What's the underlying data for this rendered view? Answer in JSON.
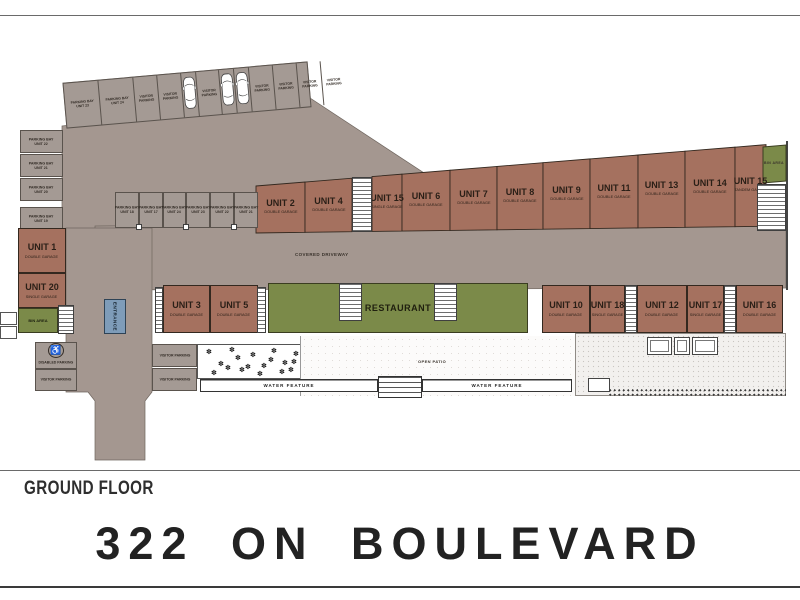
{
  "page": {
    "floor_label": "GROUND FLOOR",
    "title": "322 ON BOULEVARD"
  },
  "labels": {
    "covered_driveway": "COVERED DRIVEWAY",
    "restaurant": "RESTAURANT",
    "open_patio": "OPEN PATIO",
    "water_feature_left": "WATER FEATURE",
    "water_feature_right": "WATER FEATURE",
    "entrance": "ENTRANCE",
    "bin_area_left": "BIN AREA",
    "bin_area_right": "BIN AREA",
    "disabled_parking": "DISABLED PARKING",
    "visitor_parking_left": "VISITOR PARKING",
    "visitor_parking_right_1": "VISITOR PARKING",
    "visitor_parking_right_2": "VISITOR PARKING"
  },
  "top_parking_row": {
    "bays": [
      {
        "line1": "PARKING BAY",
        "line2": "UNIT 23",
        "car": false
      },
      {
        "line1": "PARKING BAY",
        "line2": "UNIT 24",
        "car": false
      },
      {
        "line1": "VISITOR",
        "line2": "PARKING",
        "car": false
      },
      {
        "line1": "VISITOR",
        "line2": "PARKING",
        "car": false
      },
      {
        "line1": "",
        "line2": "",
        "car": true
      },
      {
        "line1": "VISITOR",
        "line2": "PARKING",
        "car": false
      },
      {
        "line1": "",
        "line2": "",
        "car": true
      },
      {
        "line1": "",
        "line2": "",
        "car": true
      },
      {
        "line1": "VISITOR",
        "line2": "PARKING",
        "car": false
      },
      {
        "line1": "VISITOR",
        "line2": "PARKING",
        "car": false
      },
      {
        "line1": "VISITOR",
        "line2": "PARKING",
        "car": false
      },
      {
        "line1": "VISITOR",
        "line2": "PARKING",
        "car": false
      }
    ]
  },
  "left_parking_column": {
    "bays": [
      {
        "line1": "PARKING BAY",
        "line2": "UNIT 22"
      },
      {
        "line1": "PARKING BAY",
        "line2": "UNIT 21"
      },
      {
        "line1": "PARKING BAY",
        "line2": "UNIT 20"
      },
      {
        "line1": "PARKING BAY",
        "line2": "UNIT 19"
      }
    ]
  },
  "middle_parking_row": {
    "bays": [
      {
        "line1": "PARKING BAY",
        "line2": "UNIT 18"
      },
      {
        "line1": "PARKING BAY",
        "line2": "UNIT 17"
      },
      {
        "line1": "PARKING BAY",
        "line2": "UNIT 24"
      },
      {
        "line1": "PARKING BAY",
        "line2": "UNIT 23"
      },
      {
        "line1": "PARKING BAY",
        "line2": "UNIT 22"
      },
      {
        "line1": "PARKING BAY",
        "line2": "UNIT 21"
      }
    ]
  },
  "left_units": [
    {
      "name": "UNIT 1",
      "type": "DOUBLE GARAGE"
    },
    {
      "name": "UNIT 20",
      "type": "SINGLE GARAGE"
    }
  ],
  "top_units": [
    {
      "name": "UNIT 2",
      "type": "DOUBLE GARAGE"
    },
    {
      "name": "UNIT 4",
      "type": "DOUBLE GARAGE"
    },
    {
      "name": "UNIT 15",
      "type": "SINGLE GARAGE"
    },
    {
      "name": "UNIT 6",
      "type": "DOUBLE GARAGE"
    },
    {
      "name": "UNIT 7",
      "type": "DOUBLE GARAGE"
    },
    {
      "name": "UNIT 8",
      "type": "DOUBLE GARAGE"
    },
    {
      "name": "UNIT 9",
      "type": "DOUBLE GARAGE"
    },
    {
      "name": "UNIT 11",
      "type": "DOUBLE GARAGE"
    },
    {
      "name": "UNIT 13",
      "type": "DOUBLE GARAGE"
    },
    {
      "name": "UNIT 14",
      "type": "DOUBLE GARAGE"
    },
    {
      "name": "UNIT 15",
      "type": "TANDEM GARAGE"
    }
  ],
  "bottom_left_units": [
    {
      "name": "UNIT 3",
      "type": "DOUBLE GARAGE"
    },
    {
      "name": "UNIT 5",
      "type": "DOUBLE GARAGE"
    }
  ],
  "bottom_right_units": [
    {
      "name": "UNIT 10",
      "type": "DOUBLE GARAGE"
    },
    {
      "name": "UNIT 18",
      "type": "SINGLE GARAGE"
    },
    {
      "name": "UNIT 12",
      "type": "DOUBLE GARAGE"
    },
    {
      "name": "UNIT 17",
      "type": "SINGLE GARAGE"
    },
    {
      "name": "UNIT 16",
      "type": "DOUBLE GARAGE"
    }
  ],
  "colors": {
    "driveway": "#a49790",
    "parking_bay": "#a49a94",
    "unit_brown": "#a5715f",
    "green": "#7b8a49",
    "entrance_blue": "#7e9cb9"
  }
}
